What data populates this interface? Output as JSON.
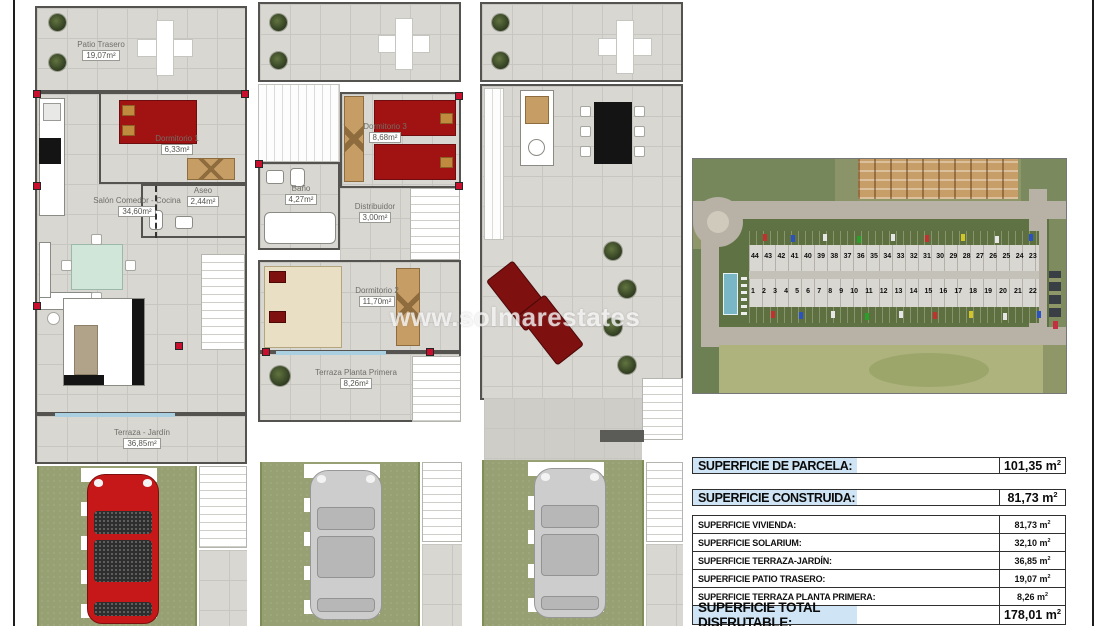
{
  "watermark": "www.solmarestates",
  "plans": {
    "ground": {
      "rooms": [
        {
          "name": "Patio Trasero",
          "area": "19,07m²"
        },
        {
          "name": "Dormitorio 1",
          "area": "6,33m²"
        },
        {
          "name": "Aseo",
          "area": "2,44m²"
        },
        {
          "name": "Salón Comedor - Cocina",
          "area": "34,60m²"
        },
        {
          "name": "Terraza - Jardín",
          "area": "36,85m²"
        }
      ]
    },
    "first": {
      "rooms": [
        {
          "name": "Dormitorio 3",
          "area": "8,68m²"
        },
        {
          "name": "Baño",
          "area": "4,27m²"
        },
        {
          "name": "Distribuidor",
          "area": "3,00m²"
        },
        {
          "name": "Dormitorio 2",
          "area": "11,70m²"
        },
        {
          "name": "Terraza Planta Primera",
          "area": "8,26m²"
        }
      ]
    },
    "solarium": {
      "rooms": []
    }
  },
  "site_map": {
    "row_top": [
      "44",
      "43",
      "42",
      "41",
      "40",
      "39",
      "38",
      "37",
      "36",
      "35",
      "34",
      "33",
      "32",
      "31",
      "30",
      "29",
      "28",
      "27",
      "26",
      "25",
      "24",
      "23"
    ],
    "row_bottom": [
      "1",
      "2",
      "3",
      "4",
      "5",
      "6",
      "7",
      "8",
      "9",
      "10",
      "11",
      "12",
      "13",
      "14",
      "15",
      "16",
      "17",
      "18",
      "19",
      "20",
      "21",
      "22"
    ]
  },
  "units": {
    "m": "m",
    "sup": "2"
  },
  "summary_table": {
    "rows_big": [
      {
        "label": "SUPERFICIE DE PARCELA:",
        "value": "101,35"
      },
      {
        "label": "SUPERFICIE CONSTRUIDA:",
        "value": "81,73"
      }
    ],
    "rows_detail": [
      {
        "label": "SUPERFICIE VIVIENDA:",
        "value": "81,73"
      },
      {
        "label": "SUPERFICIE SOLARIUM:",
        "value": "32,10"
      },
      {
        "label": "SUPERFICIE TERRAZA-JARDÍN:",
        "value": "36,85"
      },
      {
        "label": "SUPERFICIE PATIO TRASERO:",
        "value": "19,07"
      },
      {
        "label": "SUPERFICIE TERRAZA PLANTA PRIMERA:",
        "value": "8,26"
      }
    ],
    "row_total": {
      "label": "SUPERFICIE TOTAL DISFRUTABLE:",
      "value": "178,01"
    }
  },
  "colors": {
    "table_label_bg": "#cfe5f5",
    "lawn_green": "#97a073",
    "floor_tile": "#d9d7d2",
    "bed_red": "#a11212",
    "car_red": "#c61818",
    "car_gray": "#cdcdcd",
    "wood": "#c79d66",
    "pool_blue": "#79b7c6"
  }
}
